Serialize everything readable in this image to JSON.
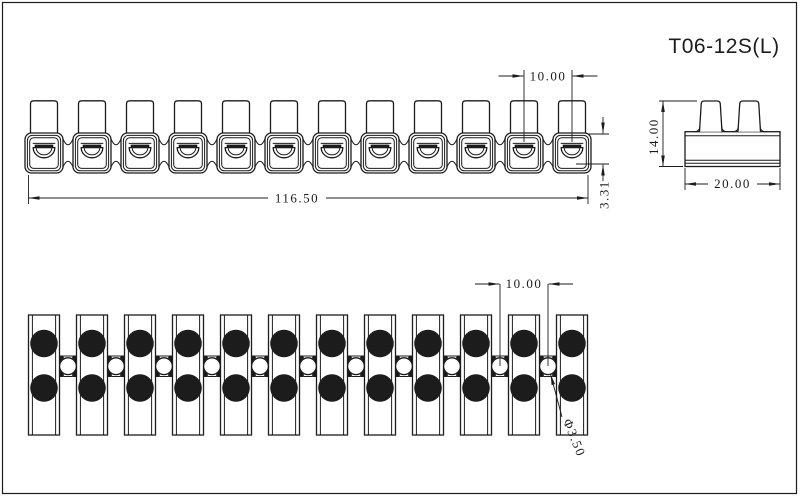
{
  "title": "T06-12S(L)",
  "colors": {
    "line": "#1c1c1c",
    "background": "#ffffff"
  },
  "front_view": {
    "label": "front-view",
    "positions": 12,
    "dim_pitch": "10.00",
    "dim_overall": "116.50",
    "dim_offset": "3.31"
  },
  "side_view": {
    "label": "side-view",
    "dim_height": "14.00",
    "dim_width": "20.00"
  },
  "top_view": {
    "label": "top-view",
    "positions": 12,
    "dim_pitch": "10.00",
    "dim_hole": "Φ3.50"
  }
}
